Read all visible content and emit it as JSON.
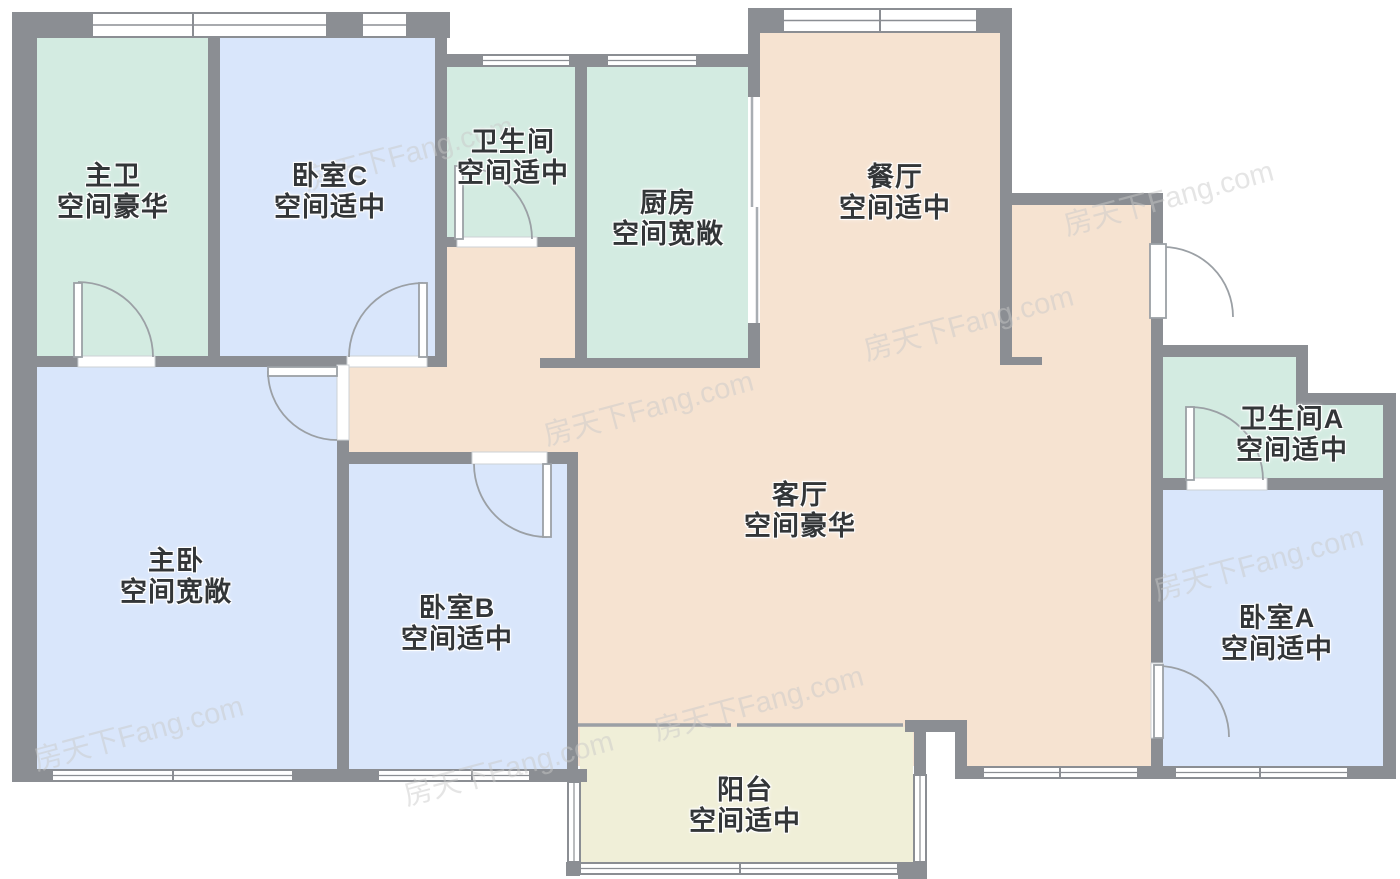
{
  "watermark": "房天下Fang.com",
  "rooms": [
    {
      "id": "master-bath",
      "name": "主卫",
      "desc": "空间豪华",
      "type": "bathroom",
      "color": "#d3ebe1"
    },
    {
      "id": "bedroom-c",
      "name": "卧室C",
      "desc": "空间适中",
      "type": "bedroom",
      "color": "#d9e6fb"
    },
    {
      "id": "bathroom",
      "name": "卫生间",
      "desc": "空间适中",
      "type": "bathroom",
      "color": "#d3ebe1"
    },
    {
      "id": "kitchen",
      "name": "厨房",
      "desc": "空间宽敞",
      "type": "kitchen",
      "color": "#d3ebe1"
    },
    {
      "id": "dining-room",
      "name": "餐厅",
      "desc": "空间适中",
      "type": "living",
      "color": "#f6e3d1"
    },
    {
      "id": "bathroom-a",
      "name": "卫生间A",
      "desc": "空间适中",
      "type": "bathroom",
      "color": "#d3ebe1"
    },
    {
      "id": "master-bedroom",
      "name": "主卧",
      "desc": "空间宽敞",
      "type": "bedroom",
      "color": "#d9e6fb"
    },
    {
      "id": "bedroom-b",
      "name": "卧室B",
      "desc": "空间适中",
      "type": "bedroom",
      "color": "#d9e6fb"
    },
    {
      "id": "living-room",
      "name": "客厅",
      "desc": "空间豪华",
      "type": "living",
      "color": "#f6e3d1"
    },
    {
      "id": "bedroom-a",
      "name": "卧室A",
      "desc": "空间适中",
      "type": "bedroom",
      "color": "#d9e6fb"
    },
    {
      "id": "balcony",
      "name": "阳台",
      "desc": "空间适中",
      "type": "balcony",
      "color": "#f0efd8"
    }
  ],
  "colors": {
    "wall": "#8b8e93",
    "door_arc": "#9ba0a5",
    "bedroom_fill": "#d9e6fb",
    "bath_kitchen_fill": "#d3ebe1",
    "living_fill": "#f6e3d1",
    "balcony_fill": "#f0efd8",
    "background": "#ffffff"
  }
}
